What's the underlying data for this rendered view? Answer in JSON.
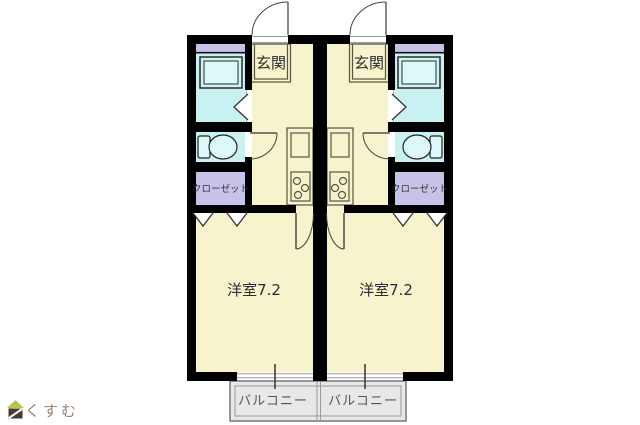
{
  "floor_plan": {
    "units": [
      {
        "name": "left-unit",
        "entrance_label": "玄関",
        "closet_label": "クローゼット",
        "room_label": "洋室7.2",
        "balcony_label": "バルコニー"
      },
      {
        "name": "right-unit",
        "entrance_label": "玄関",
        "closet_label": "クローゼット",
        "room_label": "洋室7.2",
        "balcony_label": "バルコニー"
      }
    ],
    "palette": {
      "room_fill": "#F7F3CD",
      "wet_area_fill": "#C9F1F2",
      "fixture_fill": "#DCF8F8",
      "closet_fill": "#C7C3E8",
      "balcony_fill": "#E8E8E8",
      "wall": "#000000",
      "label_text": "#2B2B2B",
      "balcony_text": "#555555"
    }
  },
  "branding": {
    "logo_text": "らくすむ",
    "logo_roof_color": "#B2C93F",
    "logo_body_color": "#483A30",
    "logo_text_color": "#9A8272"
  }
}
